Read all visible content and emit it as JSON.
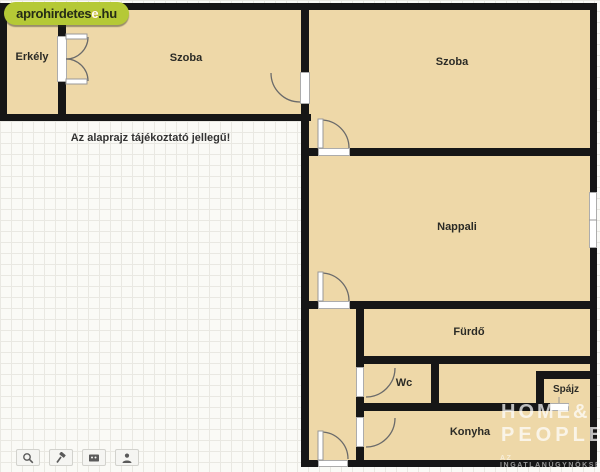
{
  "logo": {
    "text_main": "aprohirdetes",
    "text_accent": "e",
    "text_tld": ".hu",
    "bg_color": "#b5c936"
  },
  "disclaimer": "Az alaprajz tájékoztató jellegű!",
  "floorplan": {
    "rooms": {
      "erkely": "Erkély",
      "szoba_left": "Szoba",
      "szoba_right": "Szoba",
      "nappali": "Nappali",
      "furdo": "Fürdő",
      "wc": "Wc",
      "spajz": "Spájz",
      "konyha": "Konyha"
    },
    "colors": {
      "floor": "#eed8a8",
      "wall": "#161616",
      "paper": "#fafaf6",
      "grid_line": "#e9e8e2"
    }
  },
  "watermark": {
    "line1": "HOME&",
    "line2": "PEOPLE",
    "line3": "AZ INGATLANÜGYNÖKSÉG"
  },
  "toolbar": {
    "icons": [
      "search",
      "tool",
      "image",
      "user"
    ]
  }
}
